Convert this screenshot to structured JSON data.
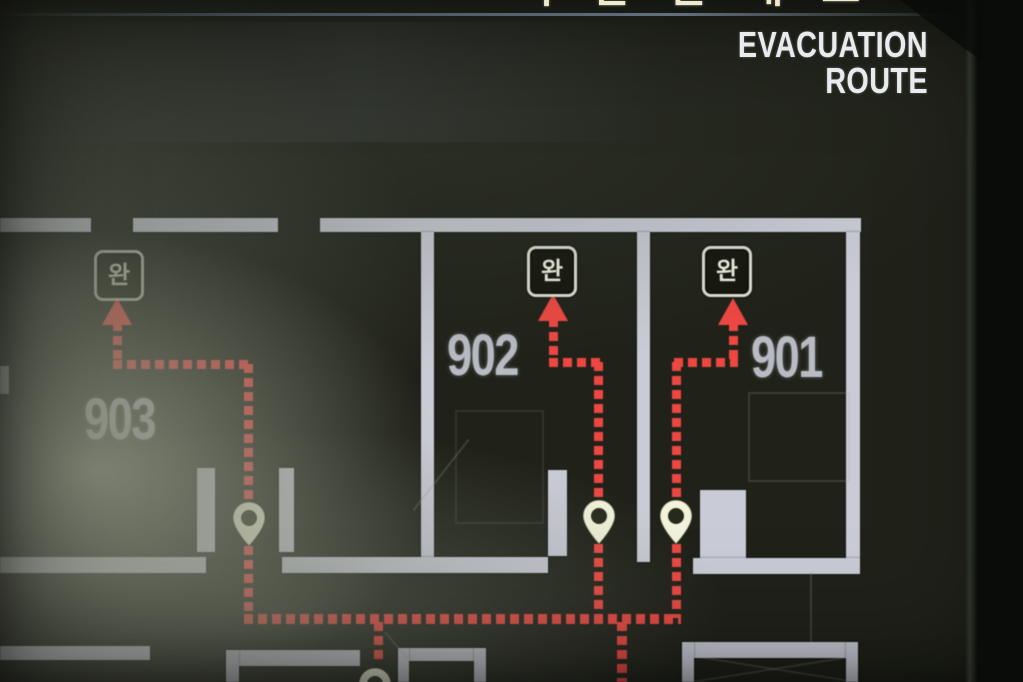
{
  "header": {
    "title_partial_korean": "피난안내도",
    "subtitle": "EVACUATION ROUTE"
  },
  "floor_plan": {
    "rooms": [
      {
        "number": "903"
      },
      {
        "number": "902"
      },
      {
        "number": "901"
      }
    ],
    "exit_badges": [
      {
        "label": "완"
      },
      {
        "label": "완"
      },
      {
        "label": "완"
      }
    ],
    "door_pin_count": 4,
    "route_style": "red dashed lines with upward arrows merging to a lower corridor trunk"
  },
  "colors": {
    "board_background": "#20221a",
    "route_red": "#ee4742",
    "wall": "#c9cbd6",
    "room_label": "#c2c5ce",
    "pin_fill": "#f2f3da",
    "badge_border": "#dfe0d2",
    "title_cream": "#efe9cf",
    "header_text": "#e9ecee"
  }
}
